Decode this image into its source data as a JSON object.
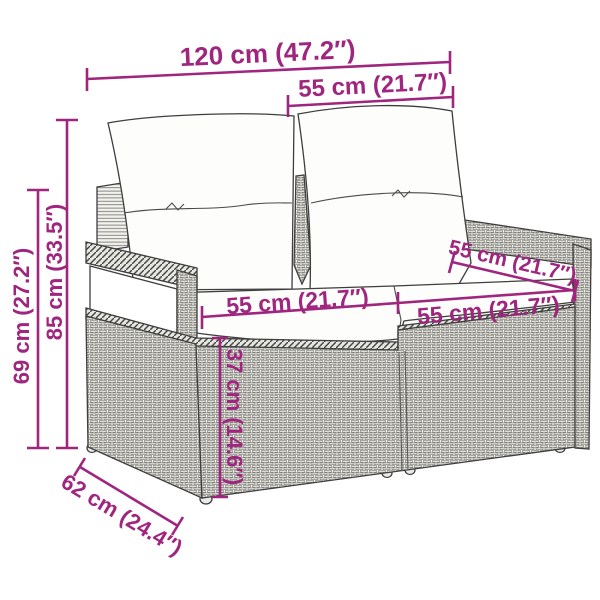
{
  "diagram_type": "product-dimension-drawing",
  "product": "poly rattan 2-seater garden sofa with cushions",
  "colors": {
    "accent": "#A0257E",
    "outline": "#3E3E3E",
    "cushion": "#FDFDFB",
    "wicker_bg": "#F1F1EE",
    "wicker_fill": "#E8E8E4",
    "wicker_stroke": "#716F69",
    "hatch_bg": "#E6E6E2",
    "hatch_stroke": "#454542",
    "crease": "#4A4A48"
  },
  "dims": {
    "overall_width": {
      "label": "120 cm (47.2″)"
    },
    "back_width": {
      "label": "55 cm (21.7″)"
    },
    "overall_height": {
      "label": "85 cm (33.5″)"
    },
    "arm_height": {
      "label": "69 cm (27.2″)"
    },
    "seat_width_left": {
      "label": "55 cm (21.7″)"
    },
    "seat_width_right": {
      "label": "55 cm (21.7″)"
    },
    "seat_depth": {
      "label": "55 cm (21.7″)"
    },
    "seat_height": {
      "label": "37 cm (14.6″)"
    },
    "base_depth": {
      "label": "62 cm (24.4″)"
    }
  }
}
